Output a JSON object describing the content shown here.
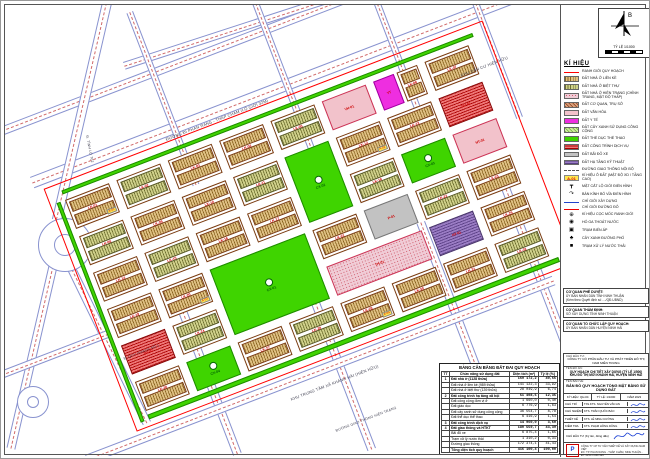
{
  "north": {
    "label": "B",
    "scale": "TỶ LỆ 1/1000"
  },
  "legend": {
    "title": "KÍ HIỆU",
    "items": [
      {
        "label": "RANH GIỚI QUY HOẠCH",
        "sw": "s-line"
      },
      {
        "label": "ĐẤT NHÀ Ở LIỀN KỀ",
        "sw": "c-lk"
      },
      {
        "label": "ĐẤT NHÀ Ở BIỆT THỰ",
        "sw": "c-lk2"
      },
      {
        "label": "ĐẤT NHÀ Ở HIỆN TRẠNG (CHỈNH TRANG, MẬT ĐỘ THẤP)",
        "sw": "c-gd"
      },
      {
        "label": "ĐẤT CƠ QUAN, TRỤ SỞ",
        "sw": "c-cq"
      },
      {
        "label": "ĐẤT VĂN HÓA",
        "sw": "c-vh"
      },
      {
        "label": "ĐẤT Y TẾ",
        "sw": "c-yt"
      },
      {
        "label": "ĐẤT CÂY XANH SỬ DỤNG CÔNG CỘNG",
        "sw": "c-cx2"
      },
      {
        "label": "ĐẤT THỂ DỤC THỂ THAO",
        "sw": "c-cx"
      },
      {
        "label": "ĐẤT CÔNG TRÌNH DỊCH VỤ",
        "sw": "c-dv"
      },
      {
        "label": "ĐẤT BÃI ĐỖ XE",
        "sw": "c-px"
      },
      {
        "label": "ĐẤT HẠ TẦNG KỸ THUẬT",
        "sw": "c-ht"
      },
      {
        "label": "ĐƯỜNG GIAO THÔNG NỘI BỘ",
        "sw": "s-dash"
      },
      {
        "label": "KÍ HIỆU Ô ĐẤT (MẬT ĐỘ XD / TẦNG CAO)",
        "sw": "s-tag",
        "glyph": "A-01"
      },
      {
        "label": "MẶT CẮT LỘ GIỚI ĐIỂN HÌNH",
        "sw": "s-glyph",
        "glyph": "┳"
      },
      {
        "label": "BÁN KÍNH BÓ VỈA ĐIỂN HÌNH",
        "sw": "s-glyph",
        "glyph": "↷"
      },
      {
        "label": "CHỈ GIỚI XÂY DỰNG",
        "sw": "s-blue"
      },
      {
        "label": "CHỈ GIỚI ĐƯỜNG ĐỎ",
        "sw": "s-red"
      },
      {
        "label": "KÍ HIỆU CỌC MỐC RANH GIỚI",
        "sw": "s-glyph",
        "glyph": "⊕"
      },
      {
        "label": "HỐ GA THOÁT NƯỚC",
        "sw": "s-glyph",
        "glyph": "◉"
      },
      {
        "label": "TRẠM BIẾN ÁP",
        "sw": "s-glyph",
        "glyph": "▣"
      },
      {
        "label": "CÂY XANH ĐƯỜNG PHỐ",
        "sw": "s-glyph",
        "glyph": "♣"
      },
      {
        "label": "TRẠM XỬ LÝ NƯỚC THẢI",
        "sw": "s-glyph",
        "glyph": "■"
      }
    ]
  },
  "notes": [
    {
      "title": "CƠ QUAN PHÊ DUYỆT:",
      "lines": [
        "ỦY BAN NHÂN DÂN TỈNH NINH THUẬN",
        "(Kèm theo Quyết định số ..../QĐ-UBND)"
      ]
    },
    {
      "title": "CƠ QUAN THẨM ĐỊNH:",
      "lines": [
        "SỞ XÂY DỰNG TỈNH NINH THUẬN"
      ]
    },
    {
      "title": "CƠ QUAN TỔ CHỨC LẬP QUY HOẠCH:",
      "lines": [
        "ỦY BAN NHÂN DÂN HUYỆN NINH HẢI"
      ]
    }
  ],
  "balance_table": {
    "title": "BẢNG CÂN BẰNG ĐẤT ĐAI QUY HOẠCH",
    "columns": [
      "TT",
      "Chức năng sử dụng đất",
      "Diện tích (m²)",
      "Tỷ lệ (%)"
    ],
    "rows": [
      {
        "tt": "1",
        "name": "Đất nhà ở (1128 thửa)",
        "area": "169 172,2",
        "pct": "40,66",
        "b": 1
      },
      {
        "tt": "",
        "name": "Đất nhà ở liền kề (989 thửa)",
        "area": "141 122,3",
        "pct": "33,92"
      },
      {
        "tt": "",
        "name": "Đất nhà ở biệt thự (139 thửa)",
        "area": "28 049,9",
        "pct": "6,74"
      },
      {
        "tt": "2",
        "name": "Đất công trình hạ tầng xã hội",
        "area": "51 408,5",
        "pct": "12,35",
        "b": 1
      },
      {
        "tt": "",
        "name": "Đất công cộng đơn vị ở",
        "area": "1 660,0",
        "pct": "0,40"
      },
      {
        "tt": "",
        "name": "Đất giáo dục",
        "area": "6 776,9",
        "pct": "1,63"
      },
      {
        "tt": "",
        "name": "Đất cây xanh sử dụng công cộng",
        "area": "36 554,7",
        "pct": "8,78"
      },
      {
        "tt": "",
        "name": "Đất thể dục thể thao",
        "area": "6 416,9",
        "pct": "1,54"
      },
      {
        "tt": "3",
        "name": "Đất công trình dịch vụ",
        "area": "14 960,0",
        "pct": "3,60",
        "b": 1
      },
      {
        "tt": "4",
        "name": "Đất giao thông và HTKT",
        "area": "180 559,7",
        "pct": "43,39",
        "b": 1
      },
      {
        "tt": "",
        "name": "Bãi đỗ xe",
        "area": "6 875,4",
        "pct": "1,65"
      },
      {
        "tt": "",
        "name": "Trạm xử lý nước thải",
        "area": "1 310,2",
        "pct": "0,31"
      },
      {
        "tt": "",
        "name": "Đường giao thông",
        "area": "172 374,1",
        "pct": "41,43"
      },
      {
        "tt": "",
        "name": "Tổng diện tích quy hoạch",
        "area": "416 100,4",
        "pct": "100,00",
        "b": 1
      }
    ]
  },
  "title_block": {
    "investor_label": "CHỦ ĐẦU TƯ:",
    "investor_lines": [
      "CÔNG TY CỔ PHẦN ĐẦU TƯ VÀ PHÁT TRIỂN ĐÔ THỊ NAM MIỀN TRUNG"
    ],
    "project_label": "TÊN ĐỒ ÁN:",
    "project_lines": [
      "QUY HOẠCH CHI TIẾT XÂY DỰNG (TỶ LỆ 1/500)",
      "KHU ĐÔ THỊ MỚI KHÁNH HẢI, HUYỆN NINH HẢI"
    ],
    "drawing_label": "TÊN BẢN VẼ:",
    "drawing_title": "BẢN ĐỒ QUY HOẠCH TỔNG MẶT BẰNG SỬ DỤNG ĐẤT",
    "meta": [
      "KÝ HIỆU: QH-04",
      "TỶ LỆ: 1/1000",
      "NĂM 2023"
    ],
    "roles": [
      {
        "role": "CHỦ TRÌ",
        "name": "ThS.KTS. NGUYỄN VĂN AN"
      },
      {
        "role": "CHỦ NHIỆM",
        "name": "KTS. TRẦN QUỐC BẢO"
      },
      {
        "role": "THIẾT KẾ",
        "name": "KTS. LÊ MINH CƯỜNG"
      },
      {
        "role": "KIỂM TRA",
        "name": "KTS. PHẠM HỒNG DŨNG"
      }
    ],
    "stamp_label": "CHỦ ĐẦU TƯ (Ký tên, đóng dấu)",
    "logo_text": "P",
    "company_lines": [
      "CÔNG TY CP TƯ VẤN THIẾT KẾ VÀ XÂY DỰNG NAM VIỆT",
      "ĐC: TP. PHAN RANG - THÁP CHÀM, NINH THUẬN - ĐT: 0259 3 888 999"
    ]
  },
  "map": {
    "rotation": -21,
    "area": {
      "x": 60,
      "y": 195,
      "w": 440,
      "h": 235
    },
    "boundary": {
      "u": -16,
      "v": -18,
      "w": 470,
      "h": 260
    },
    "strips": [
      {
        "u": 0,
        "v": 230,
        "w": 440,
        "h": 5
      },
      {
        "u": 0,
        "v": -10,
        "w": 440,
        "h": 4
      },
      {
        "u": -9,
        "v": 0,
        "w": 4,
        "h": 235
      }
    ],
    "cells": [
      {
        "u": 0,
        "v": 0,
        "t": "lk",
        "l": "LK-01",
        "tag": "A-01"
      },
      {
        "u": 55,
        "v": 0,
        "t": "lk2",
        "l": "LK-02"
      },
      {
        "u": 110,
        "v": 0,
        "t": "lk",
        "l": "LK-03"
      },
      {
        "u": 165,
        "v": 0,
        "t": "lk",
        "l": "LK-04"
      },
      {
        "u": 220,
        "v": 0,
        "t": "lk2",
        "l": "LK-05"
      },
      {
        "u": 275,
        "v": 0,
        "t": "vh",
        "l": "VH-01"
      },
      {
        "u": 330,
        "v": 0,
        "w": 22,
        "t": "yt",
        "l": "YT"
      },
      {
        "u": 355,
        "v": 0,
        "w": 22,
        "t": "lk",
        "l": "LK-06"
      },
      {
        "u": 385,
        "v": 0,
        "t": "lk",
        "l": "LK-07"
      },
      {
        "u": 0,
        "v": 39,
        "t": "lk2",
        "l": "LK-08"
      },
      {
        "u": 55,
        "v": 39,
        "t": "lk",
        "l": "LK-09"
      },
      {
        "u": 110,
        "v": 39,
        "t": "lk",
        "l": "LK-10"
      },
      {
        "u": 165,
        "v": 39,
        "t": "lk2",
        "l": "LK-11"
      },
      {
        "u": 220,
        "v": 39,
        "h": 70,
        "t": "cx",
        "l": "CX-02"
      },
      {
        "u": 275,
        "v": 39,
        "t": "lk",
        "l": "LK-12",
        "tag": "A-02"
      },
      {
        "u": 330,
        "v": 39,
        "t": "lk",
        "l": "LK-13"
      },
      {
        "u": 385,
        "v": 39,
        "t": "dv",
        "l": "DV-01"
      },
      {
        "u": 0,
        "v": 78,
        "t": "lk",
        "l": "LK-14"
      },
      {
        "u": 55,
        "v": 78,
        "t": "lk2",
        "l": "LK-15"
      },
      {
        "u": 110,
        "v": 78,
        "t": "lk",
        "l": "LK-16"
      },
      {
        "u": 165,
        "v": 78,
        "t": "lk",
        "l": "LK-17"
      },
      {
        "u": 275,
        "v": 78,
        "t": "lk2",
        "l": "LK-18"
      },
      {
        "u": 330,
        "v": 78,
        "t": "cx",
        "l": "CX-03"
      },
      {
        "u": 385,
        "v": 78,
        "t": "vh",
        "l": "NT-01"
      },
      {
        "u": 0,
        "v": 117,
        "t": "lk",
        "l": "LK-19"
      },
      {
        "u": 55,
        "v": 117,
        "t": "lk",
        "l": "LK-20",
        "tag": "A-03"
      },
      {
        "u": 110,
        "v": 117,
        "w": 102,
        "h": 70,
        "t": "cx",
        "l": "CX-01"
      },
      {
        "u": 220,
        "v": 117,
        "t": "lk",
        "l": "LK-21"
      },
      {
        "u": 275,
        "v": 117,
        "t": "px",
        "l": "P-01"
      },
      {
        "u": 330,
        "v": 117,
        "t": "lk2",
        "l": "LK-22"
      },
      {
        "u": 385,
        "v": 117,
        "t": "lk",
        "l": "LK-23"
      },
      {
        "u": 0,
        "v": 156,
        "t": "dv",
        "l": "DV-02"
      },
      {
        "u": 55,
        "v": 156,
        "t": "lk2",
        "l": "LK-24"
      },
      {
        "u": 220,
        "v": 156,
        "w": 102,
        "t": "gd",
        "l": "TH-01"
      },
      {
        "u": 330,
        "v": 156,
        "t": "ht",
        "l": "HT-01"
      },
      {
        "u": 385,
        "v": 156,
        "t": "lk",
        "l": "LK-25"
      },
      {
        "u": 0,
        "v": 195,
        "t": "lk",
        "l": "LK-26"
      },
      {
        "u": 55,
        "v": 195,
        "t": "cx",
        "l": "CX-04"
      },
      {
        "u": 110,
        "v": 195,
        "t": "lk",
        "l": "LK-27"
      },
      {
        "u": 165,
        "v": 195,
        "t": "lk2",
        "l": "LK-28"
      },
      {
        "u": 220,
        "v": 195,
        "t": "lk",
        "l": "LK-29",
        "tag": "A-04"
      },
      {
        "u": 275,
        "v": 195,
        "t": "lk",
        "l": "LK-30"
      },
      {
        "u": 330,
        "v": 195,
        "t": "lk",
        "l": "LK-31"
      },
      {
        "u": 385,
        "v": 195,
        "t": "lk2",
        "l": "LK-32"
      }
    ],
    "roads": [
      {
        "x": 25,
        "y": 172,
        "l": 640,
        "w": 12,
        "d": -21
      },
      {
        "x": -5,
        "y": 122,
        "l": 620,
        "w": 9,
        "d": -21
      },
      {
        "x": 118,
        "y": 57,
        "l": 460,
        "w": 8,
        "d": -18
      },
      {
        "x": 128,
        "y": 6,
        "l": 185,
        "w": 7,
        "d": 69
      },
      {
        "x": 252,
        "y": -8,
        "l": 168,
        "w": 7,
        "d": 69
      },
      {
        "x": 372,
        "y": -12,
        "l": 148,
        "w": 7,
        "d": 69
      },
      {
        "x": 472,
        "y": -8,
        "l": 128,
        "w": 7,
        "d": 69
      },
      {
        "x": 180,
        "y": 300,
        "l": 158,
        "w": 9,
        "d": 69
      },
      {
        "x": 300,
        "y": 258,
        "l": 198,
        "w": 9,
        "d": 69
      },
      {
        "x": 420,
        "y": 216,
        "l": 225,
        "w": 9,
        "d": 69
      },
      {
        "x": 505,
        "y": 182,
        "l": 195,
        "w": 9,
        "d": 69
      },
      {
        "x": 80,
        "y": 450,
        "l": 500,
        "w": 10,
        "d": -21
      },
      {
        "x": 58,
        "y": 238,
        "l": 212,
        "w": 9,
        "d": 103
      },
      {
        "x": 108,
        "y": -6,
        "l": 228,
        "w": 10,
        "d": 103
      },
      {
        "x": 60,
        "y": 240,
        "l": 196,
        "w": 9,
        "d": 64
      },
      {
        "x": -10,
        "y": 368,
        "l": 120,
        "w": 8,
        "d": -21
      }
    ],
    "circles": [
      {
        "x": 60,
        "y": 240,
        "r": 27
      },
      {
        "x": 60,
        "y": 240,
        "r": 11
      },
      {
        "x": 28,
        "y": 397,
        "r": 16
      },
      {
        "x": 28,
        "y": 397,
        "r": 6
      }
    ],
    "labels": [
      {
        "t": "ĐƯỜNG ĐI PHAN RANG - THÁP CHÀM (LỘ GIỚI 32M)",
        "x": 160,
        "y": 132,
        "d": -21,
        "s": 4
      },
      {
        "t": "KHU DÂN CƯ HIỆN HỮU",
        "x": 455,
        "y": 68,
        "d": -21,
        "s": 4
      },
      {
        "t": "KHU TRUNG TÂM XÃ KHÁNH HẢI (HIỆN HỮU)",
        "x": 285,
        "y": 392,
        "d": -21,
        "s": 4
      },
      {
        "t": "ĐƯỜNG GIAO THÔNG HIỆN TRẠNG",
        "x": 330,
        "y": 424,
        "d": -21,
        "s": 3.5
      },
      {
        "t": "Đ. TỈNH LỘ 702",
        "x": 84,
        "y": 130,
        "d": 79,
        "s": 3.5
      },
      {
        "t": "Đ. QUY HOẠCH SỐ 1",
        "x": 118,
        "y": 352,
        "d": -21,
        "s": 3.5
      }
    ]
  }
}
